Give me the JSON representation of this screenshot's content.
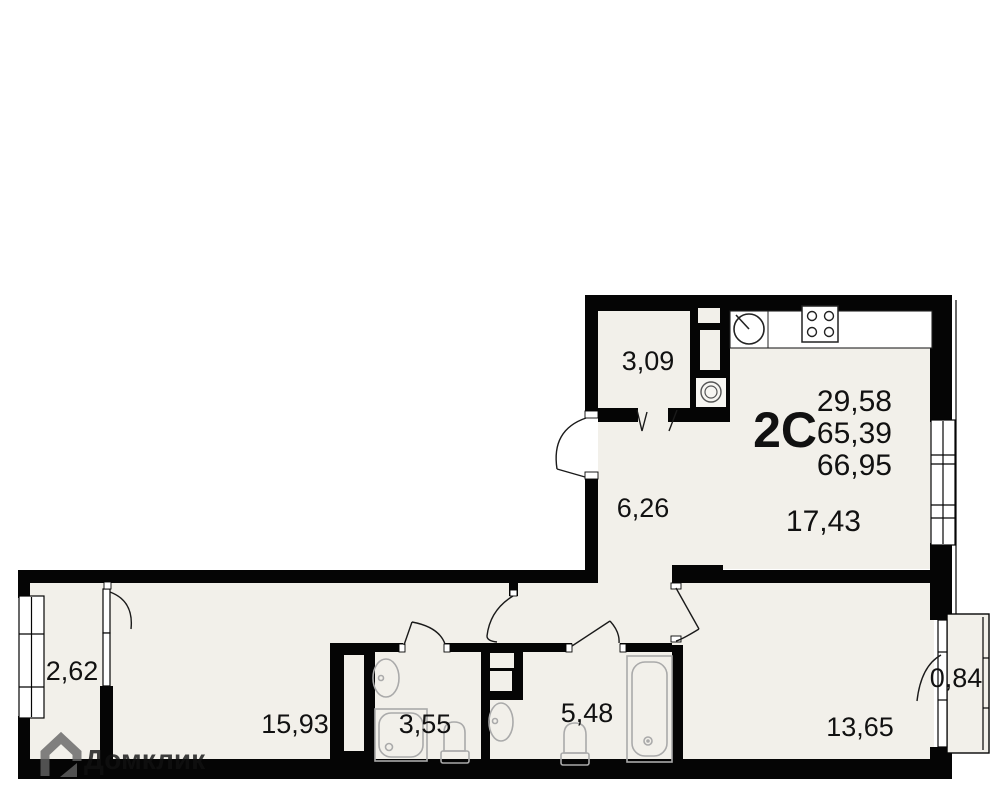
{
  "plan": {
    "type_label": "2С",
    "summary": {
      "living_area": "29,58",
      "area_main": "65,39",
      "area_total": "66,95"
    },
    "rooms": {
      "storage": {
        "area": "3,09"
      },
      "hallway": {
        "area": "6,26"
      },
      "kitchen_living": {
        "area": "17,43"
      },
      "balcony_left": {
        "area": "2,62"
      },
      "bedroom_left": {
        "area": "15,93"
      },
      "shower_room": {
        "area": "3,55"
      },
      "bathroom": {
        "area": "5,48"
      },
      "bedroom_right": {
        "area": "13,65"
      },
      "balcony_right": {
        "area": "0,84"
      }
    },
    "watermark": {
      "brand": "Домклик"
    },
    "colors": {
      "wall": "#050505",
      "floor": "#f2f0ea",
      "fixture": "#aaaaaa",
      "text": "#111111",
      "watermark": "#646464"
    },
    "fixtures": [
      "kitchen-sink-icon",
      "stove-icon",
      "washing-machine-icon",
      "bathroom-sink-icon",
      "shower-tray-icon",
      "toilet-icon",
      "bathtub-icon",
      "window-icon",
      "door-swing-icon"
    ]
  }
}
